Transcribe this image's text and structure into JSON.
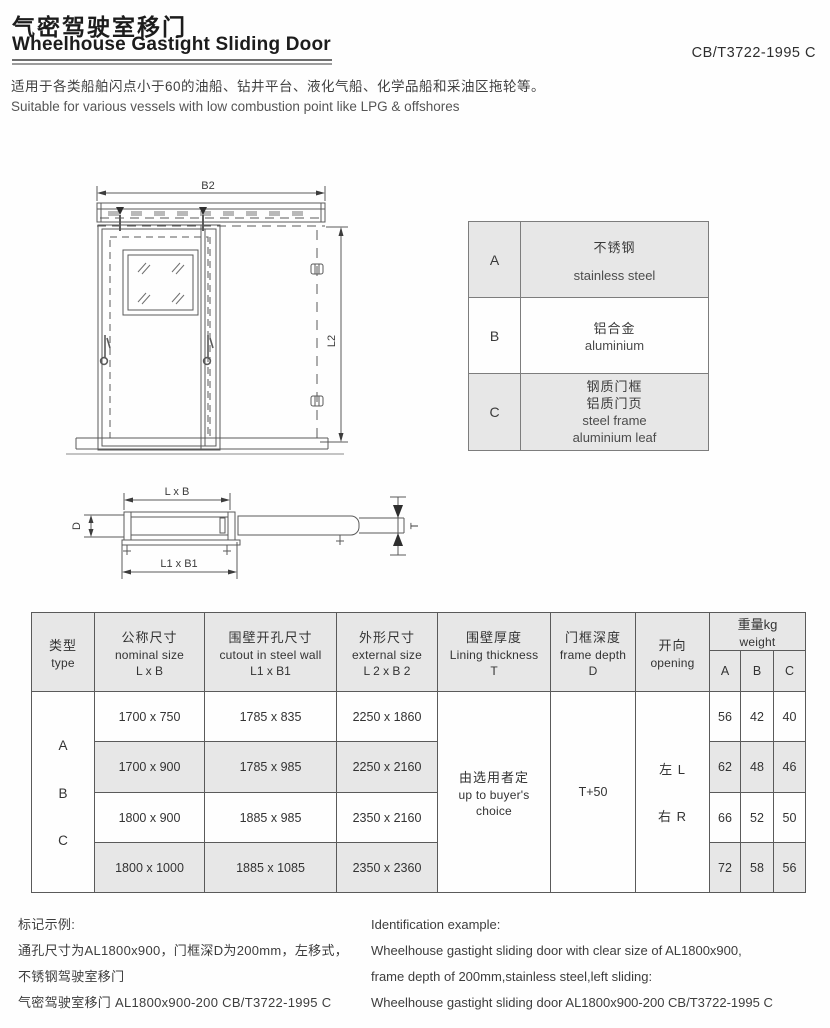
{
  "page": {
    "title_zh": "气密驾驶室移门",
    "title_en": "Wheelhouse Gastight Sliding Door",
    "standard_code": "CB/T3722-1995 C",
    "desc_zh": "适用于各类船舶闪点小于60的油船、钻井平台、液化气船、化学品船和采油区拖轮等。",
    "desc_en": "Suitable for various vessels with low combustion point like LPG & offshores"
  },
  "front_view": {
    "dim_b2": "B2",
    "dim_l2": "L2"
  },
  "plan_view": {
    "dim_lxb": "L x B",
    "dim_l1xb1": "L1 x B1",
    "dim_d": "D",
    "dim_t": "T"
  },
  "material_table": {
    "rows": [
      {
        "key": "A",
        "zh": "不锈钢",
        "en": "stainless steel"
      },
      {
        "key": "B",
        "zh": "铝合金",
        "en": "aluminium"
      },
      {
        "key": "C",
        "zh1": "钢质门框",
        "zh2": "铝质门页",
        "en1": "steel frame",
        "en2": "aluminium leaf"
      }
    ]
  },
  "spec_table": {
    "headers": {
      "type_zh": "类型",
      "type_en": "type",
      "nominal_zh": "公称尺寸",
      "nominal_en": "nominal size",
      "nominal_sub": "L x B",
      "cutout_zh": "围壁开孔尺寸",
      "cutout_en": "cutout in steel wall",
      "cutout_sub": "L1 x B1",
      "external_zh": "外形尺寸",
      "external_en": "external size",
      "external_sub": "L 2  x B 2",
      "lining_zh": "围壁厚度",
      "lining_en": "Lining thickness",
      "lining_sub": "T",
      "depth_zh": "门框深度",
      "depth_en": "frame depth",
      "depth_sub": "D",
      "opening_zh": "开向",
      "opening_en": "opening",
      "weight_zh": "重量kg",
      "weight_en": "weight",
      "weight_cols": [
        "A",
        "B",
        "C"
      ]
    },
    "type_letters": [
      "A",
      "B",
      "C"
    ],
    "rows": [
      {
        "nominal": "1700 x 750",
        "cutout": "1785 x 835",
        "external": "2250 x 1860",
        "wa": "56",
        "wb": "42",
        "wc": "40"
      },
      {
        "nominal": "1700 x 900",
        "cutout": "1785 x 985",
        "external": "2250 x 2160",
        "wa": "62",
        "wb": "48",
        "wc": "46"
      },
      {
        "nominal": "1800 x 900",
        "cutout": "1885 x 985",
        "external": "2350 x 2160",
        "wa": "66",
        "wb": "52",
        "wc": "50"
      },
      {
        "nominal": "1800 x 1000",
        "cutout": "1885 x 1085",
        "external": "2350 x 2360",
        "wa": "72",
        "wb": "58",
        "wc": "56"
      }
    ],
    "merged": {
      "lining_zh": "由选用者定",
      "lining_en1": "up to buyer's",
      "lining_en2": "choice",
      "depth": "T+50",
      "opening_left": "左 L",
      "opening_right": "右 R"
    }
  },
  "footer": {
    "left": [
      "标记示例:",
      "通孔尺寸为AL1800x900，门框深D为200mm，左移式，",
      "不锈钢驾驶室移门",
      "气密驾驶室移门 AL1800x900-200 CB/T3722-1995 C"
    ],
    "right": [
      "Identification example:",
      "Wheelhouse gastight sliding door with clear size of AL1800x900,",
      "frame depth of 200mm,stainless steel,left sliding:",
      "Wheelhouse gastight sliding door AL1800x900-200 CB/T3722-1995 C"
    ]
  }
}
